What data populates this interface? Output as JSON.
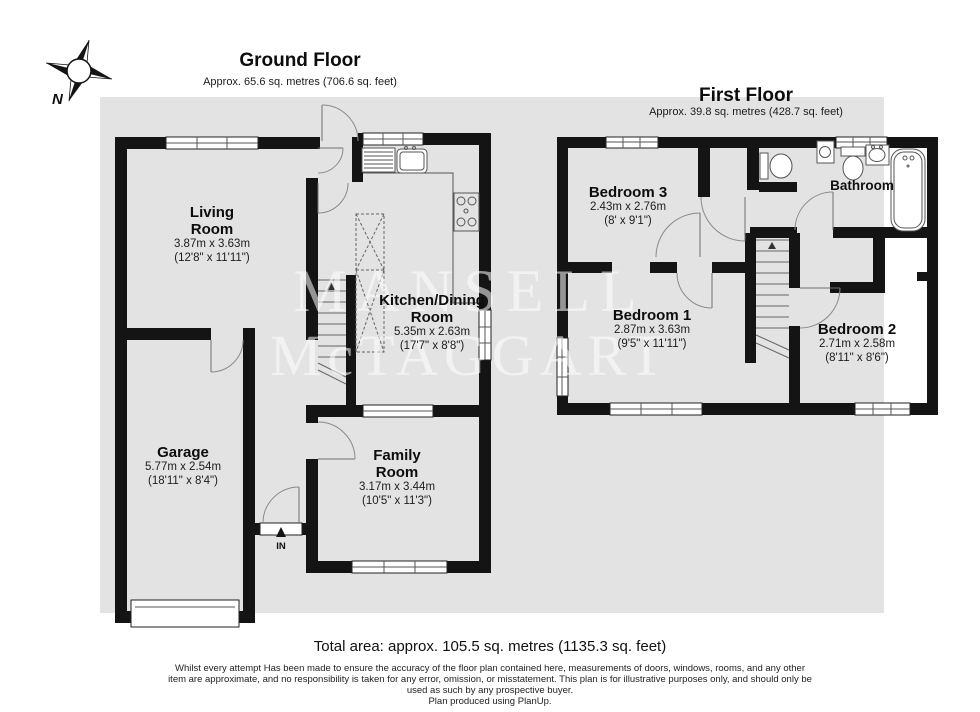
{
  "page": {
    "background": "#ffffff",
    "plan_background": "#e3e3e3",
    "wall_color": "#141414"
  },
  "compass": {
    "north_label": "N"
  },
  "watermark": {
    "line1": "MANSELL",
    "line2": "McTAGGART"
  },
  "ground_floor": {
    "title": "Ground Floor",
    "area": "Approx. 65.6 sq. metres (706.6 sq. feet)",
    "entrance_label": "IN",
    "rooms": {
      "living_room": {
        "name_line1": "Living",
        "name_line2": "Room",
        "metric": "3.87m x 3.63m",
        "imperial": "(12'8\" x 11'11\")"
      },
      "kitchen_dining_room": {
        "name_line1": "Kitchen/Dining",
        "name_line2": "Room",
        "metric": "5.35m x 2.63m",
        "imperial": "(17'7\" x 8'8\")"
      },
      "garage": {
        "name_line1": "Garage",
        "metric": "5.77m x 2.54m",
        "imperial": "(18'11\" x 8'4\")"
      },
      "family_room": {
        "name_line1": "Family",
        "name_line2": "Room",
        "metric": "3.17m x 3.44m",
        "imperial": "(10'5\" x 11'3\")"
      }
    }
  },
  "first_floor": {
    "title": "First Floor",
    "area": "Approx. 39.8 sq. metres (428.7 sq. feet)",
    "rooms": {
      "bedroom_3": {
        "name_line1": "Bedroom 3",
        "metric": "2.43m x 2.76m",
        "imperial": "(8' x 9'1\")"
      },
      "bedroom_1": {
        "name_line1": "Bedroom 1",
        "metric": "2.87m x 3.63m",
        "imperial": "(9'5\" x 11'11\")"
      },
      "bedroom_2": {
        "name_line1": "Bedroom 2",
        "metric": "2.71m x 2.58m",
        "imperial": "(8'11\" x 8'6\")"
      },
      "bathroom": {
        "name_line1": "Bathroom"
      }
    }
  },
  "footer": {
    "total_area": "Total area: approx. 105.5 sq. metres (1135.3 sq. feet)",
    "disclaimer_lines": [
      "Whilst every attempt Has been made to ensure the accuracy of the floor plan contained here, measurements of doors, windows, rooms, and any other",
      "item are approximate, and no responsibility is taken for any error, omission, or misstatement. This plan is for illustrative purposes only, and should only be",
      "used as such by any prospective buyer.",
      "Plan produced using PlanUp."
    ]
  }
}
